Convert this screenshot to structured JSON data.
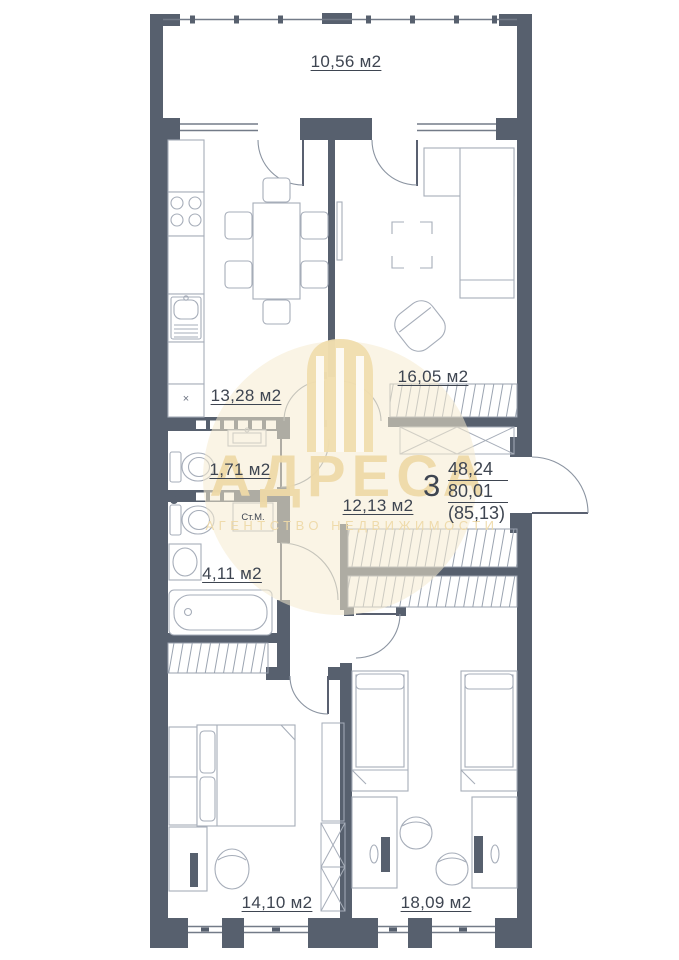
{
  "watermark": {
    "title": "АДРЕСА",
    "subtitle": "АГЕНТСТВО НЕДВИЖИМОСТИ"
  },
  "apartment": {
    "rooms_count": "3",
    "areas": {
      "living": "48,24",
      "apartment": "80,01",
      "total": "(85,13)"
    },
    "rooms": {
      "balcony": {
        "label": "10,56 м2"
      },
      "kitchen": {
        "label": "13,28 м2"
      },
      "living_room": {
        "label": "16,05 м2"
      },
      "wc": {
        "label": "1,71 м2"
      },
      "hallway": {
        "label": "12,13 м2"
      },
      "bathroom": {
        "label": "4,11 м2"
      },
      "bedroom_left": {
        "label": "14,10 м2"
      },
      "bedroom_right": {
        "label": "18,09 м2"
      }
    },
    "annotations": {
      "washing_machine": "Ст.М.",
      "kitchen_marker": "×"
    }
  },
  "colors": {
    "wall": "#57606e",
    "furniture_line": "#a6adb9",
    "label_text": "#3e4551",
    "watermark": "#eed9a8",
    "background": "#ffffff"
  }
}
